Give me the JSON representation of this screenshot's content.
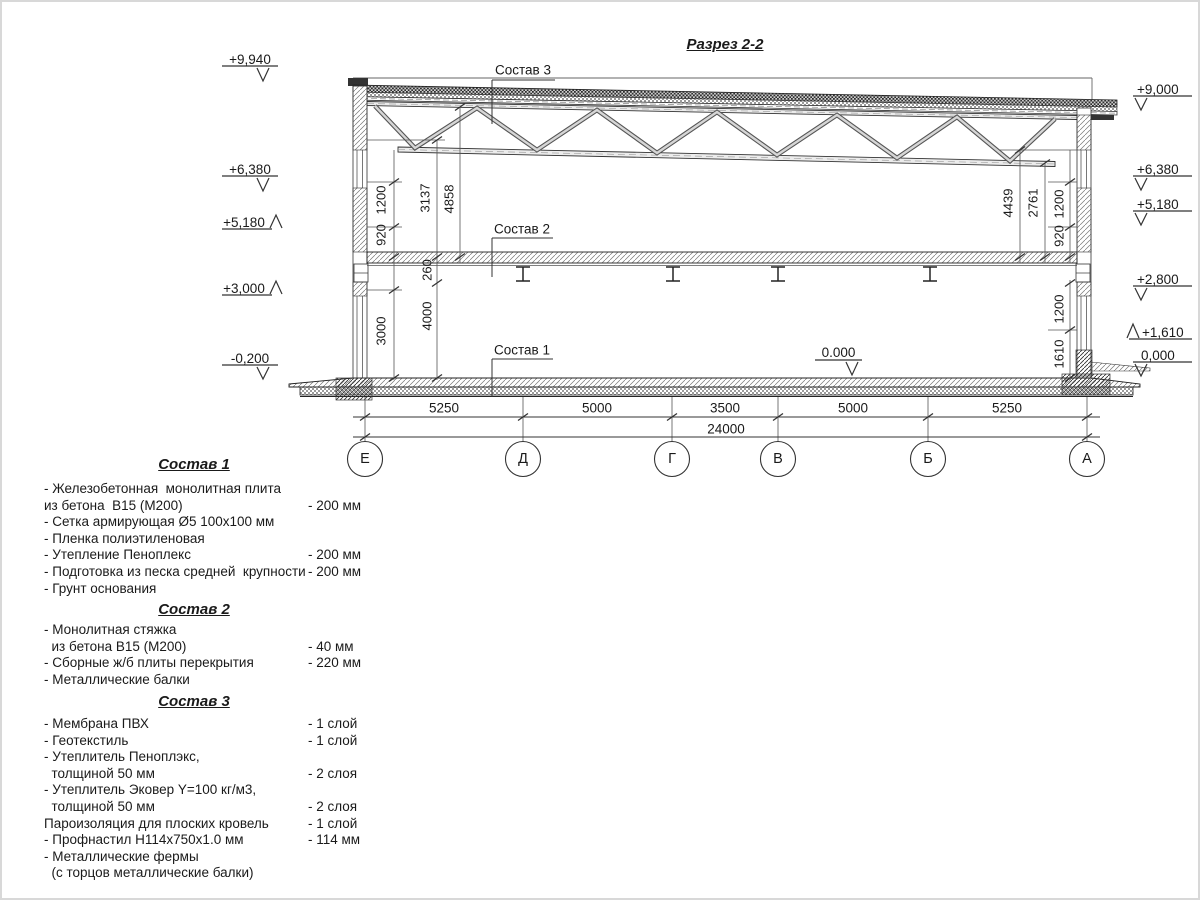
{
  "title": "Разрез 2-2",
  "marks": {
    "left": [
      "+9,940",
      "+6,380",
      "+5,180",
      "+3,000",
      "-0,200"
    ],
    "right": [
      "+9,000",
      "+6,380",
      "+5,180",
      "+2,800",
      "+1,610",
      "0,000"
    ],
    "floor_zero": "0.000"
  },
  "callouts": [
    "Состав 3",
    "Состав 2",
    "Состав 1"
  ],
  "dims": {
    "vertical_left": [
      "1200",
      "920",
      "3137",
      "4858",
      "260",
      "3000",
      "4000"
    ],
    "vertical_right": [
      "4439",
      "2761",
      "1200",
      "920",
      "1200",
      "1610"
    ],
    "bottom": [
      "5250",
      "5000",
      "3500",
      "5000",
      "5250"
    ],
    "total": "24000"
  },
  "axes": [
    "Е",
    "Д",
    "Г",
    "В",
    "Б",
    "А"
  ],
  "specs": [
    {
      "title": "Состав 1",
      "items": [
        {
          "text": "- Железобетонная  монолитная плита",
          "value": ""
        },
        {
          "text": "из бетона  В15 (М200)",
          "value": "- 200 мм"
        },
        {
          "text": "- Сетка армирующая Ø5 100х100 мм",
          "value": ""
        },
        {
          "text": "- Пленка полиэтиленовая",
          "value": ""
        },
        {
          "text": "- Утепление Пеноплекс",
          "value": "- 200 мм"
        },
        {
          "text": "- Подготовка из песка средней  крупности",
          "value": "- 200 мм"
        },
        {
          "text": "- Грунт основания",
          "value": ""
        }
      ]
    },
    {
      "title": "Состав 2",
      "items": [
        {
          "text": "- Монолитная стяжка",
          "value": ""
        },
        {
          "text": "  из бетона В15 (М200)",
          "value": "- 40 мм"
        },
        {
          "text": "- Сборные ж/б плиты перекрытия",
          "value": "- 220 мм"
        },
        {
          "text": "- Металлические балки",
          "value": ""
        }
      ]
    },
    {
      "title": "Состав 3",
      "items": [
        {
          "text": "- Мембрана ПВХ",
          "value": "- 1 слой"
        },
        {
          "text": "- Геотекстиль",
          "value": "- 1 слой"
        },
        {
          "text": "- Утеплитель Пеноплэкс,",
          "value": ""
        },
        {
          "text": "  толщиной 50 мм",
          "value": "- 2 слоя"
        },
        {
          "text": "- Утеплитель Эковер Y=100 кг/м3,",
          "value": ""
        },
        {
          "text": "  толщиной 50 мм",
          "value": "- 2 слоя"
        },
        {
          "text": "Пароизоляция для плоских кровель",
          "value": "- 1 слой"
        },
        {
          "text": "- Профнастил Н114х750х1.0 мм",
          "value": "- 114 мм"
        },
        {
          "text": "- Металлические фермы",
          "value": ""
        },
        {
          "text": "  (с торцов металлические балки)",
          "value": ""
        }
      ]
    }
  ]
}
